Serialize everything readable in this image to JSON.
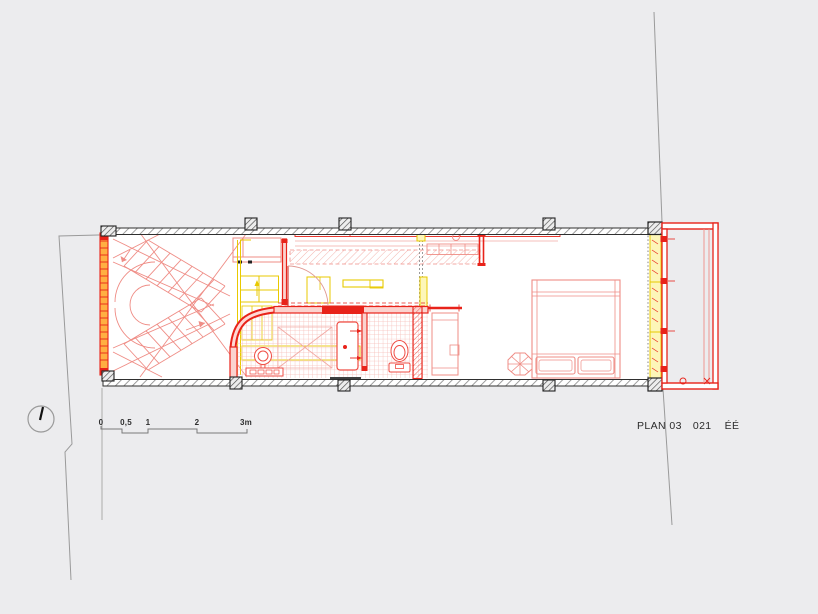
{
  "title_block": {
    "plan_label": "PLAN 03",
    "sheet_number": "021",
    "revision_label": "ÉÉ"
  },
  "scale_bar": {
    "labels": [
      "0",
      "0,5",
      "1",
      "2",
      "3m"
    ]
  },
  "symbols": {
    "north_indicator": "circle-with-tick",
    "wall_fill": "diagonal-hatch",
    "bathroom_floor": "fine-red-tile-grid"
  },
  "colors": {
    "bg": "#ececee",
    "ink": "#2e2e2e",
    "line_gray": "#9a9a9a",
    "hatch_gray": "#8d8d8d",
    "wall_red": "#e8231a",
    "light_red": "#ef8d86",
    "pale_red": "#f2aaa4",
    "tile_red": "#f6beb9",
    "yellow": "#e8c900",
    "pale_yellow": "#fdf6b8",
    "orange": "#ffae42"
  }
}
